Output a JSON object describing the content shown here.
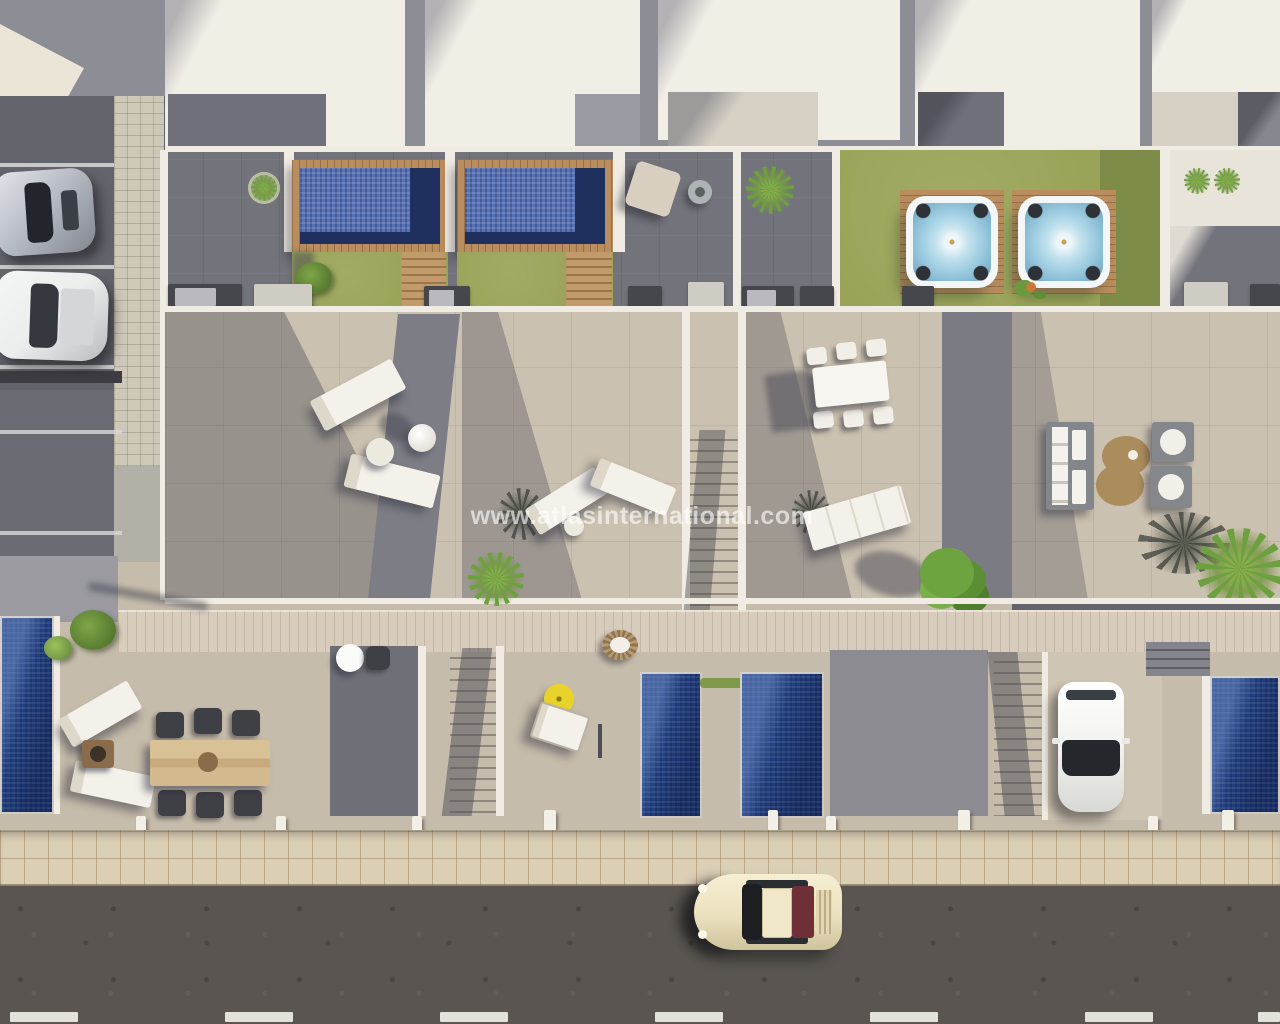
{
  "scene": {
    "title": "Aerial 3D render of a townhouse development",
    "watermark": "www.atlasinternational.com"
  },
  "palette": {
    "roof-white": "#f1eee6",
    "roof-gray": "#8d8d95",
    "roof-recess": "#70707a",
    "terrace-dark": "#73737b",
    "tile-beige": "#cbc1b0",
    "tile-low": "#c6bcab",
    "lawn": "#9aa458",
    "lawn-shade": "#7e8c49",
    "wood-deck": "#b98d5e",
    "pool-blue": "#5872b6",
    "pool-navy": "#1f2f5e",
    "pool-deep": "#22407e",
    "jacuzzi-blue": "#a8d2e4",
    "walkway": "#d8cdbc",
    "sidewalk": "#dbcfb6",
    "road": "#5a5550",
    "marking-white": "#eeeee6",
    "parking": "#63636b",
    "paver": "#cdc8b8",
    "parasol-yellow": "#e9d32b",
    "rug-brown": "#ab8c5c",
    "plant-green": "#6da03f",
    "white-wall": "#f0ece3",
    "car-cream": "#ece1bf",
    "car-silver": "#b9bec6",
    "car-white": "#eceded"
  },
  "inventory": {
    "rooftop_plunge_pools": 2,
    "jacuzzis": 2,
    "lower_garden_pools": 4,
    "parked_cars": 4,
    "sun_loungers": 8,
    "dining_sets": 3,
    "sofa_set": 1
  }
}
